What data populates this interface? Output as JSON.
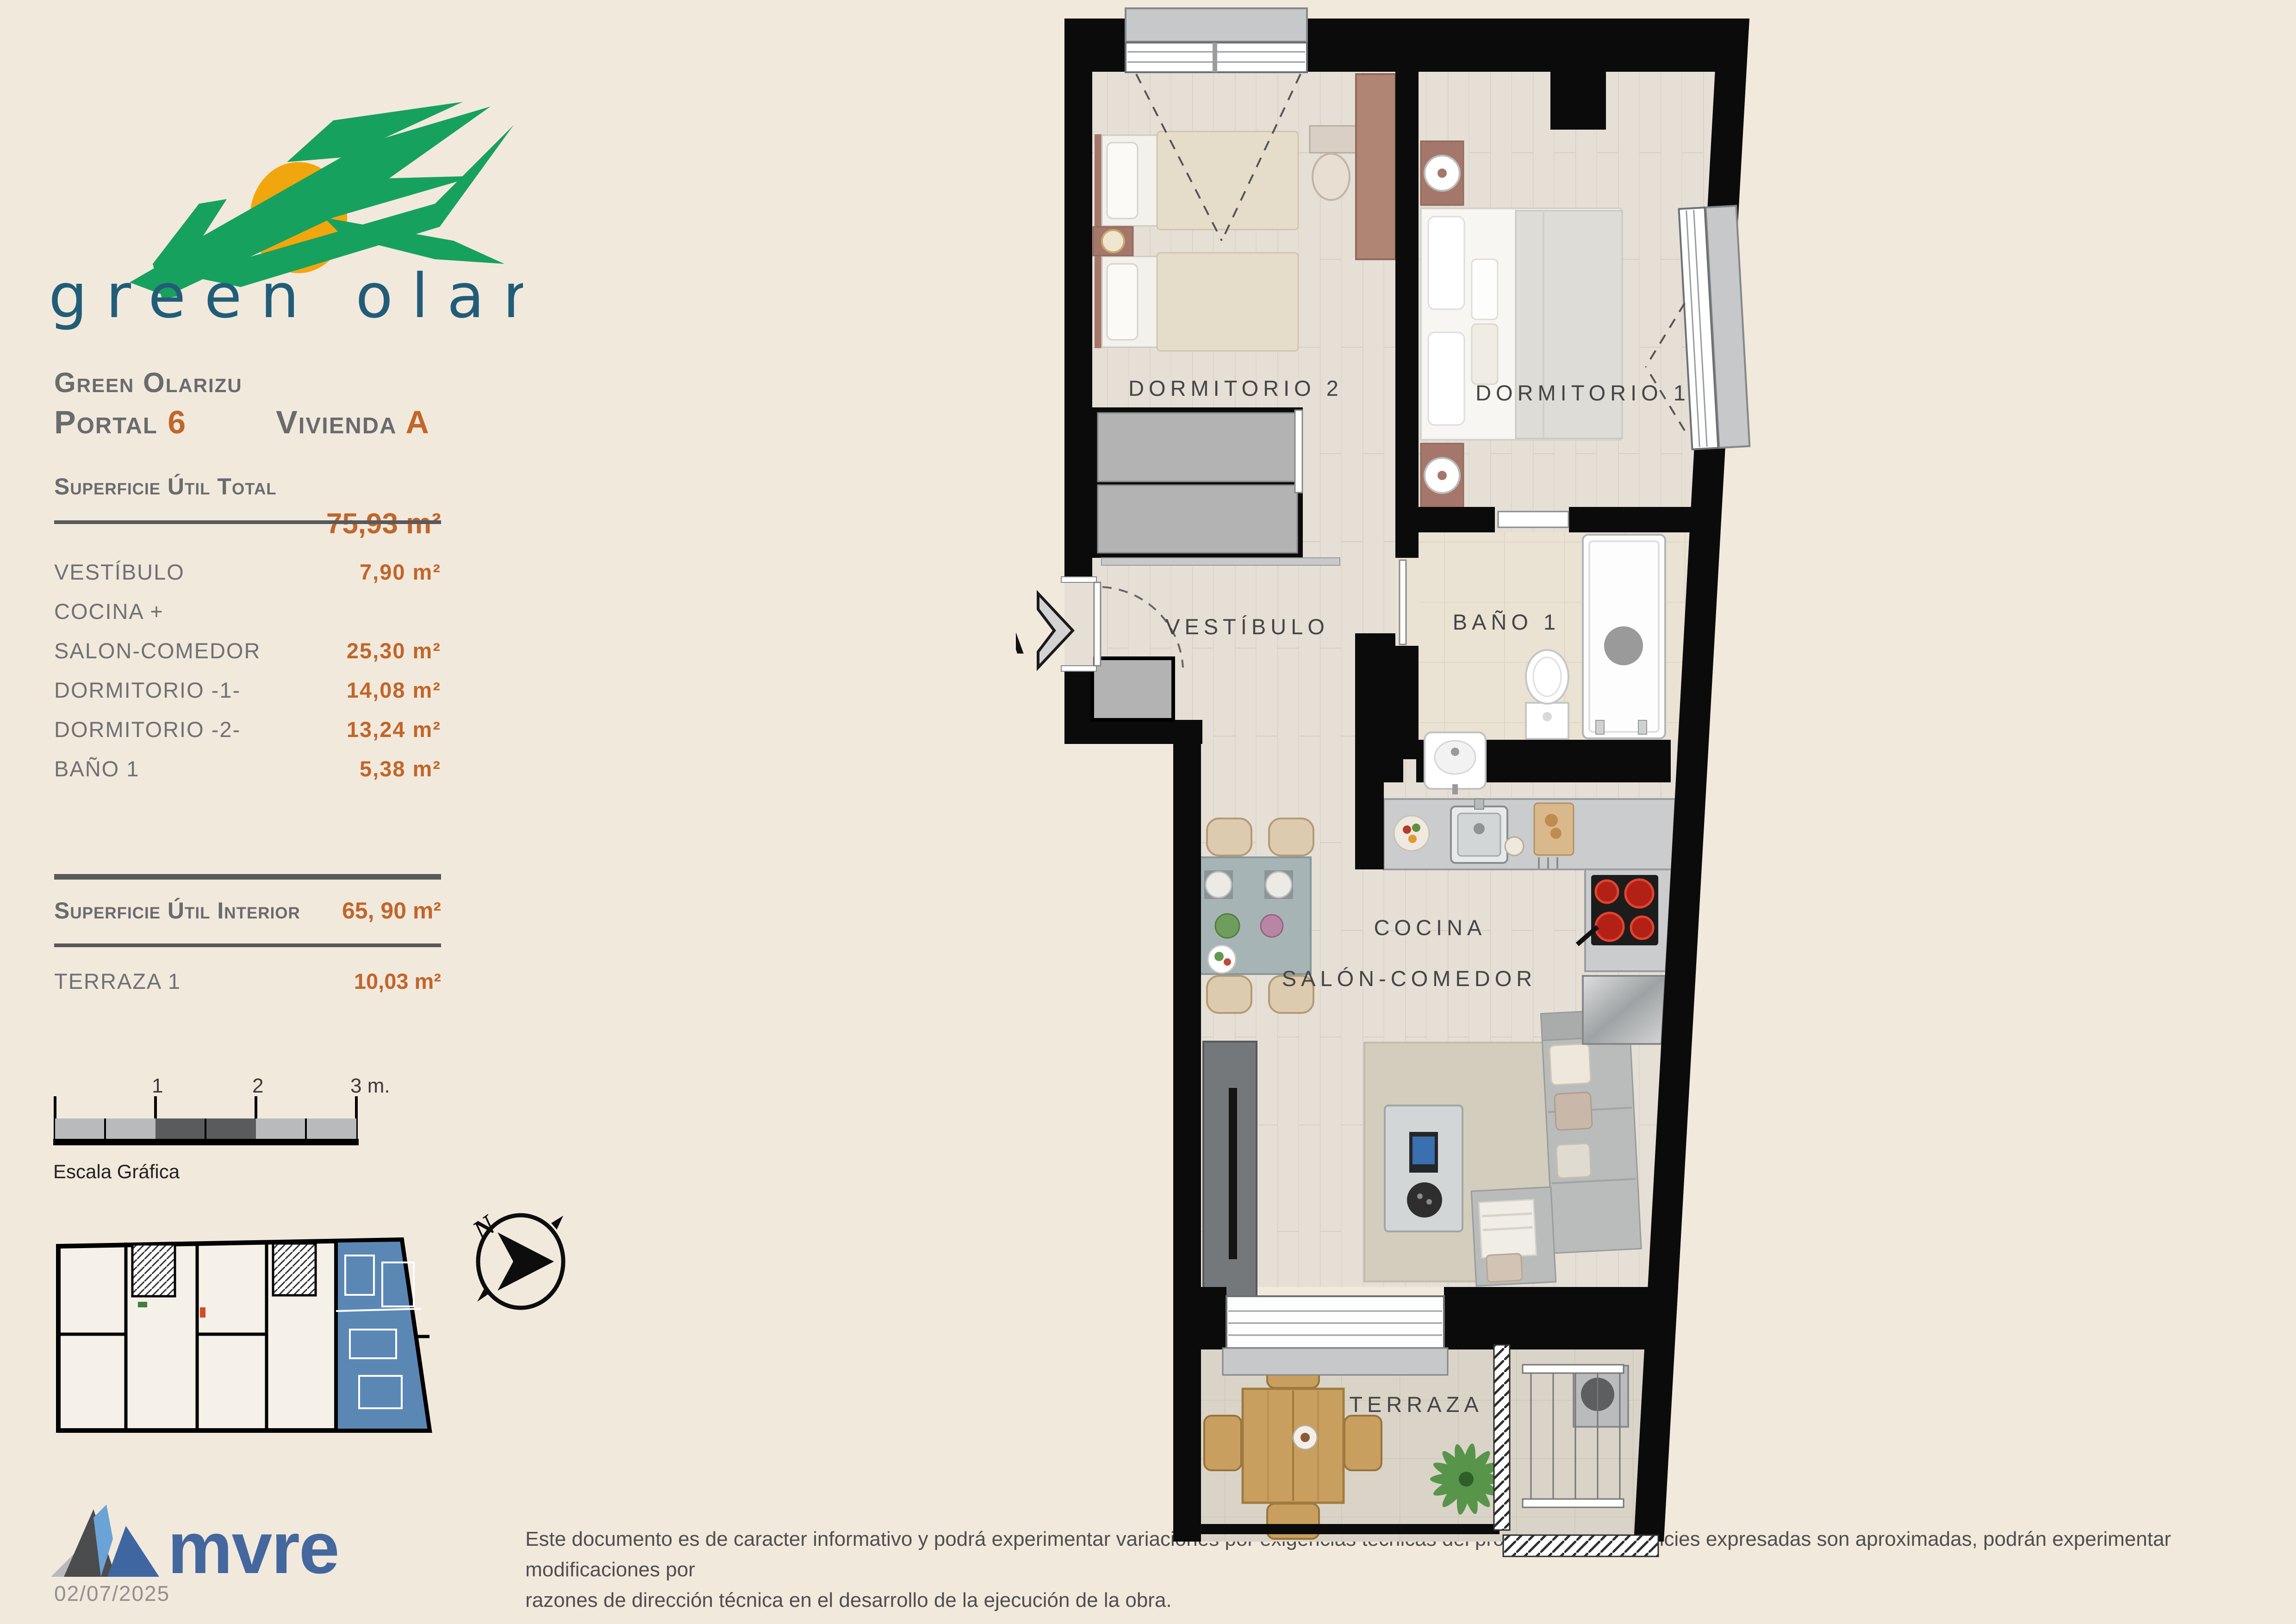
{
  "logo": {
    "text": "green olarizu"
  },
  "header": {
    "project": "Green Olarizu",
    "portal_label": "Portal",
    "portal_value": "6",
    "vivienda_label": "Vivienda",
    "vivienda_value": "A",
    "total_label": "Superficie Útil Total",
    "total_value": "75,93 m²"
  },
  "surface_table": {
    "rows": [
      {
        "label": "VESTÍBULO",
        "value": "7,90 m²"
      },
      {
        "label": "COCINA +",
        "value": ""
      },
      {
        "label": "SALON-COMEDOR",
        "value": "25,30 m²"
      },
      {
        "label": "DORMITORIO -1-",
        "value": "14,08 m²"
      },
      {
        "label": "DORMITORIO -2-",
        "value": "13,24 m²"
      },
      {
        "label": "BAÑO 1",
        "value": "5,38 m²"
      }
    ],
    "interior_label": "Superficie Útil Interior",
    "interior_value": "65, 90 m²",
    "terrace_label": "TERRAZA 1",
    "terrace_value": "10,03 m²"
  },
  "scalebar": {
    "tick1": "1",
    "tick2": "2",
    "tick3": "3 m.",
    "label": "Escala Gráfica"
  },
  "compass": {
    "north": "N"
  },
  "plan": {
    "dormitorio2": "DORMITORIO 2",
    "dormitorio1": "DORMITORIO 1",
    "vestibulo": "VESTÍBULO",
    "bano": "BAÑO 1",
    "cocina": "COCINA",
    "salon": "SALÓN-COMEDOR",
    "terraza": "TERRAZA",
    "section_marker": "A"
  },
  "footer": {
    "brand": "mvre",
    "disclaimer_line1": "Este documento es de caracter informativo y podrá experimentar variaciones por exigencias técnicas del proyecto. Las superficies expresadas son aproximadas, podrán experimentar modificaciones por",
    "disclaimer_line2": "razones de dirección técnica en el desarrollo de la ejecución de la obra.",
    "date": "02/07/2025"
  },
  "colors": {
    "accent_orange": "#c1662b",
    "brand_blue": "#44679e",
    "logo_green": "#17a15e",
    "logo_sun": "#f2a60d",
    "logo_teal": "#215d78",
    "highlight_unit_blue": "#5b87b5"
  }
}
